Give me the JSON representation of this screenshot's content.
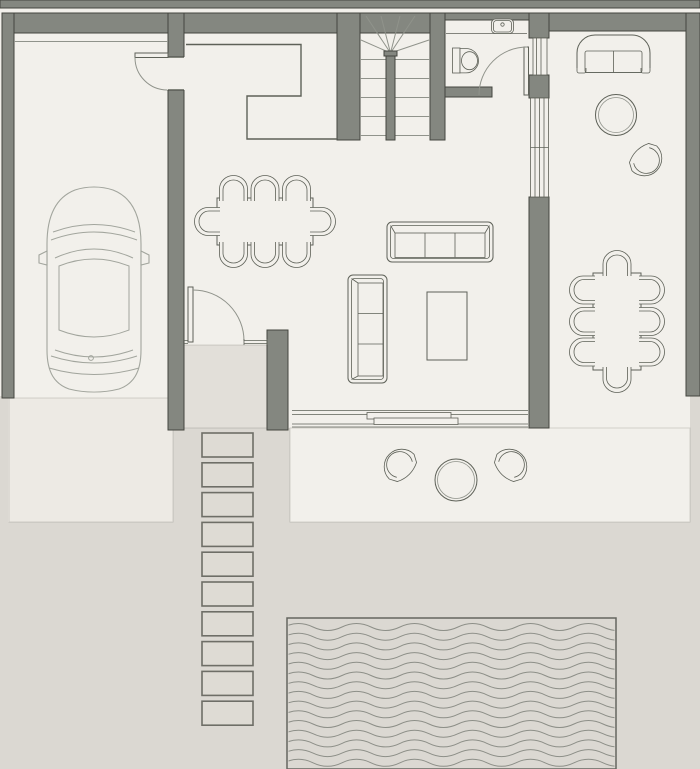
{
  "title": "Architectural floor plan — ground floor with garage, living area, covered terrace, stepping-stone path and pool",
  "palette": {
    "ground": "#dbd8d2",
    "floor": "#f2f0eb",
    "porch": "#e2dfd9",
    "driveway": "#edeae4",
    "stoneFill": "#dedbd4",
    "stoneEdge": "#6e6e67",
    "wall": "#848780",
    "wallEdge": "#44463f",
    "line": "#5e6158",
    "lineSoft": "#90938b",
    "carLine": "#a2a59d",
    "wave": "#8d8f88",
    "poolEdge": "#64665f",
    "hairline": "rgba(60,60,55,0.18)"
  },
  "rooms": [
    "garage",
    "entry-hall",
    "kitchen",
    "living-room",
    "dining-area",
    "bathroom",
    "staircase",
    "covered-terrace",
    "terrace",
    "driveway",
    "pool",
    "garden"
  ],
  "stones": {
    "x": 202,
    "width": 51,
    "height": 24,
    "y0": 433,
    "pitch": 29.8,
    "count": 10
  },
  "waves": {
    "x": 284,
    "y0": 627,
    "rows": 15,
    "spacing": 9.7,
    "half": 29,
    "amp": 7,
    "segments": 13
  },
  "treads": {
    "ys": [
      59.5,
      78.5,
      97.5,
      116.5,
      135.5
    ],
    "left": [
      360,
      386
    ],
    "right": [
      395,
      430
    ]
  },
  "winders": {
    "origin": [
      390.5,
      53
    ],
    "targets": [
      [
        361,
        40
      ],
      [
        366,
        16
      ],
      [
        381,
        16
      ],
      [
        400,
        16
      ],
      [
        415,
        16
      ],
      [
        429,
        40
      ]
    ]
  },
  "archPath": "M-14,10 V-2 A14,13.5 0 0 1 14,-2 V10 M-10.5,10 V-1 A10.5,10 0 0 1 10.5,-1 V10",
  "archChairs": [
    {
      "cx": 233.5,
      "cy": 191,
      "rot": 0
    },
    {
      "cx": 265,
      "cy": 191,
      "rot": 0
    },
    {
      "cx": 296.5,
      "cy": 191,
      "rot": 0
    },
    {
      "cx": 233.5,
      "cy": 252,
      "rot": 180
    },
    {
      "cx": 265,
      "cy": 252,
      "rot": 180
    },
    {
      "cx": 296.5,
      "cy": 252,
      "rot": 180
    },
    {
      "cx": 210,
      "cy": 221.5,
      "rot": -90
    },
    {
      "cx": 320,
      "cy": 221.5,
      "rot": 90
    },
    {
      "cx": 617,
      "cy": 266,
      "rot": 0
    },
    {
      "cx": 617,
      "cy": 377,
      "rot": 180
    },
    {
      "cx": 585,
      "cy": 290,
      "rot": -90
    },
    {
      "cx": 585,
      "cy": 321.5,
      "rot": -90
    },
    {
      "cx": 585,
      "cy": 352,
      "rot": -90
    },
    {
      "cx": 649,
      "cy": 290,
      "rot": 90
    },
    {
      "cx": 649,
      "cy": 321.5,
      "rot": 90
    },
    {
      "cx": 649,
      "cy": 352,
      "rot": 90
    }
  ],
  "barrelPath": "M-13.5,8.5 L-17.5,1 A17.5,17.5 0 1 1 17.5,1 L13.5,8.5 Q0,15 -13.5,8.5 Z M-11,5 A13,13 0 1 1 11,5",
  "barrelChairs": [
    {
      "cx": 645,
      "cy": 159,
      "rot": 135
    },
    {
      "cx": 401,
      "cy": 466,
      "rot": -45
    },
    {
      "cx": 510,
      "cy": 466,
      "rot": 45
    }
  ]
}
